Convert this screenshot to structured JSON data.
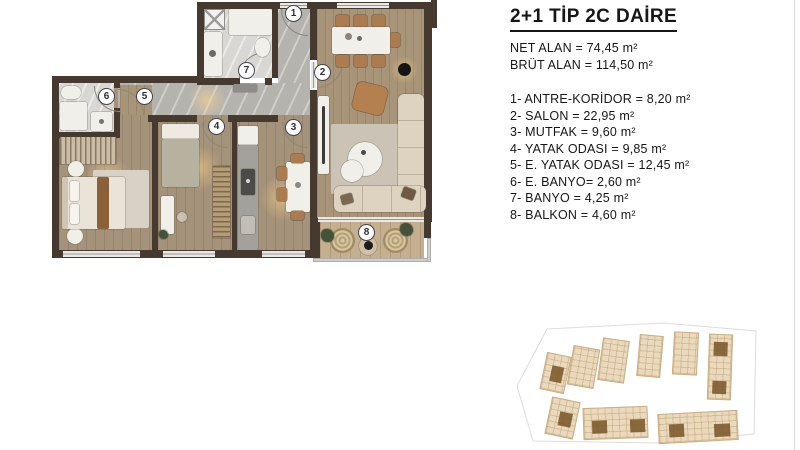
{
  "title": "2+1 TİP 2C DAİRE",
  "areas": {
    "net": "NET ALAN = 74,45 m²",
    "brut": "BRÜT ALAN = 114,50 m²"
  },
  "legend": {
    "items": [
      {
        "num": "1",
        "name": "ANTRE-KORİDOR",
        "area": "8,20 m²",
        "text": "1- ANTRE-KORİDOR  = 8,20 m²"
      },
      {
        "num": "2",
        "name": "SALON",
        "area": "22,95 m²",
        "text": "2- SALON = 22,95 m²"
      },
      {
        "num": "3",
        "name": "MUTFAK",
        "area": "9,60 m²",
        "text": "3- MUTFAK = 9,60 m²"
      },
      {
        "num": "4",
        "name": "YATAK ODASI",
        "area": "9,85 m²",
        "text": "4- YATAK ODASI = 9,85 m²"
      },
      {
        "num": "5",
        "name": "E. YATAK ODASI",
        "area": "12,45 m²",
        "text": "5- E. YATAK ODASI = 12,45 m²"
      },
      {
        "num": "6",
        "name": "E. BANYO",
        "area": "2,60 m²",
        "text": "6- E. BANYO= 2,60 m²"
      },
      {
        "num": "7",
        "name": "BANYO",
        "area": "4,25 m²",
        "text": "7- BANYO = 4,25 m²"
      },
      {
        "num": "8",
        "name": "BALKON",
        "area": "4,60 m²",
        "text": "8- BALKON = 4,60 m²"
      }
    ]
  },
  "plan": {
    "room_numbers": [
      "1",
      "2",
      "3",
      "4",
      "5",
      "6",
      "7",
      "8"
    ]
  },
  "colors": {
    "wall": "#463a30",
    "wood_floor": "#a5927a",
    "corridor_floor": "#b5b3ae",
    "bath_floor": "#d9d7d3",
    "balcony_floor": "#c5af91",
    "highlight_unit": "#7d5b2e",
    "text": "#161616"
  }
}
